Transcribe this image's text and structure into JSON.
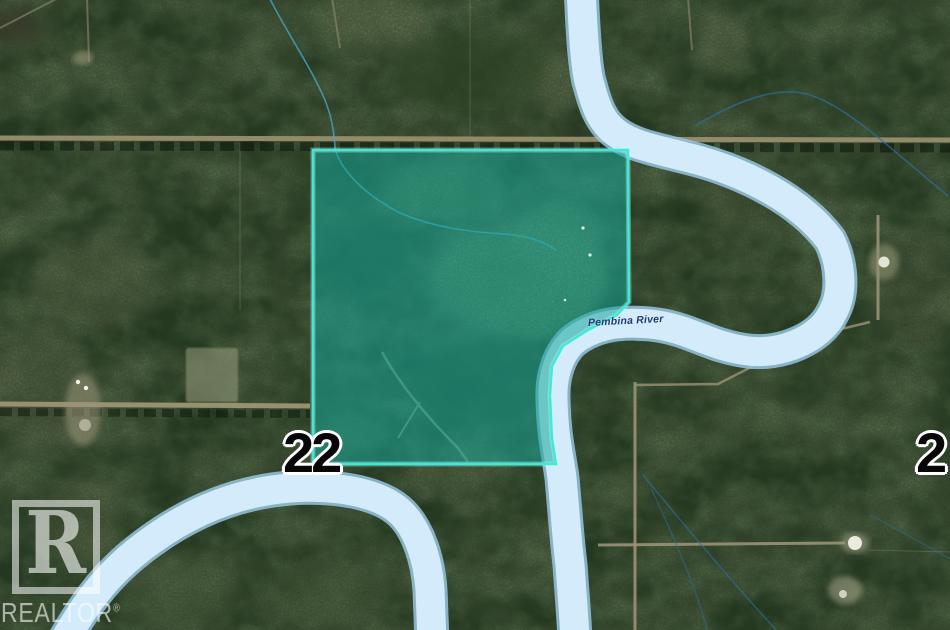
{
  "map": {
    "kind": "aerial-parcel-listing-map",
    "river_label": "Pembina River",
    "section_number_left": "22",
    "section_number_right": "2",
    "watermark": {
      "logo_letter": "R",
      "name": "REALTOR",
      "registered": "®"
    },
    "colors": {
      "parcel_fill": "#17a899",
      "parcel_border": "#3fe9d9",
      "river_fill": "#d3ebfa",
      "river_casing": "#97c5e1",
      "forest_base": "#24331c",
      "road_tan": "#938a6c",
      "river_label_text": "#1c3c74",
      "section_number_fill": "#070707",
      "section_number_outline": "#ffffff",
      "watermark_white": "rgba(255,255,255,0.58)"
    }
  }
}
